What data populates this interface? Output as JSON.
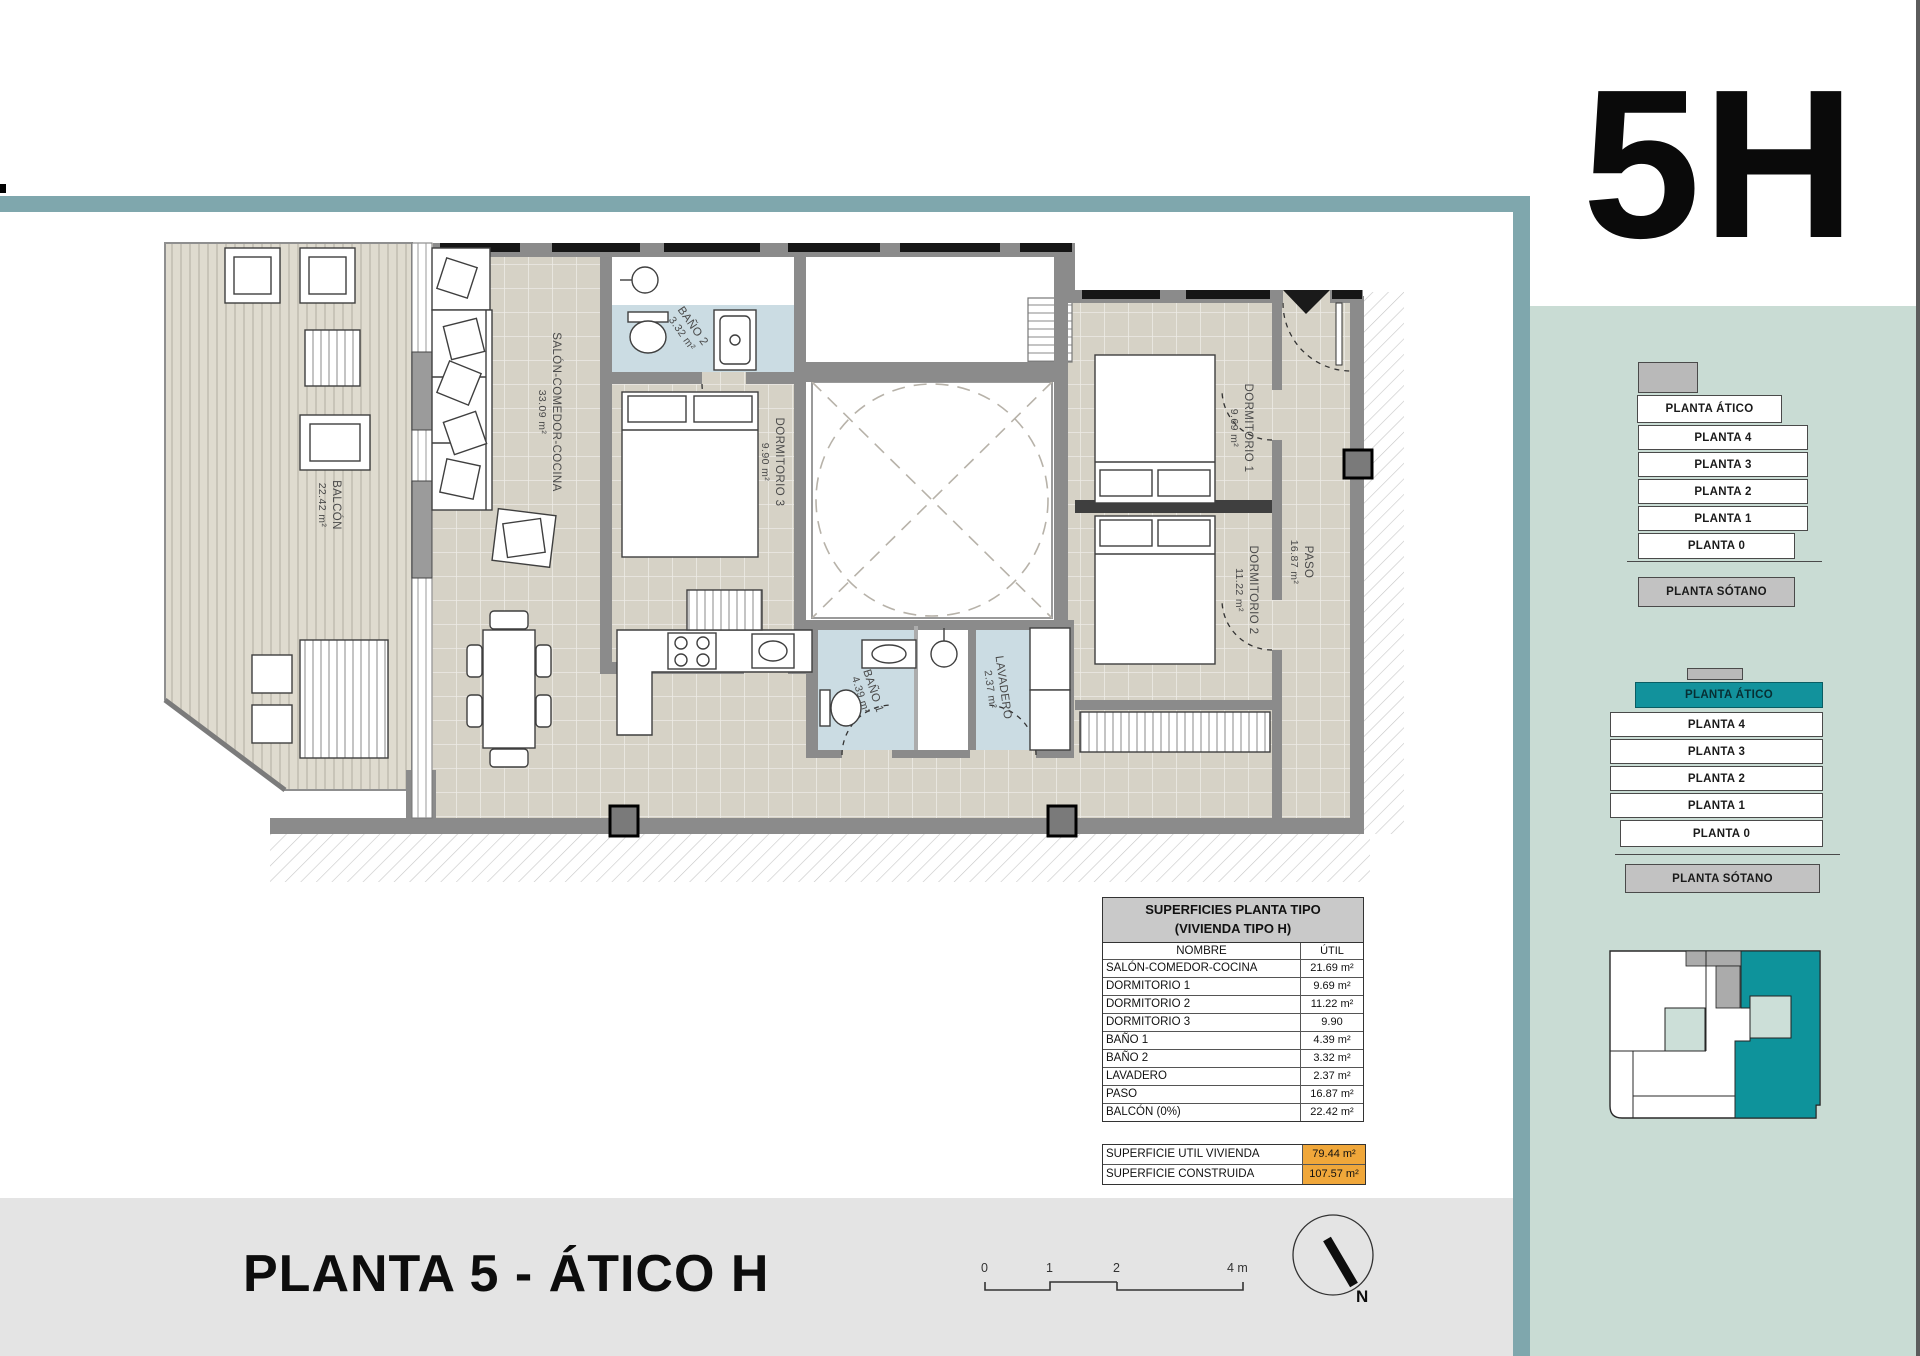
{
  "unit_code": "5H",
  "page_title": "PLANTA 5 - ÁTICO H",
  "colors": {
    "accent_teal": "#12929C",
    "band_teal": "#7FA7AD",
    "sidebar_bg": "#C9DCD4",
    "highlight_orange": "#F0A73A"
  },
  "plan": {
    "rooms": [
      {
        "name": "BALCÓN",
        "area": "22.42 m²"
      },
      {
        "name": "SALÓN-COMEDOR-COCINA",
        "area": "33.09 m²"
      },
      {
        "name": "BAÑO 2",
        "area": "3.32 m²"
      },
      {
        "name": "DORMITORIO 3",
        "area": "9.90 m²"
      },
      {
        "name": "DORMITORIO 1",
        "area": "9.69 m²"
      },
      {
        "name": "DORMITORIO 2",
        "area": "11.22 m²"
      },
      {
        "name": "PASO",
        "area": "16.87 m²"
      },
      {
        "name": "BAÑO 1",
        "area": "4.39 m²"
      },
      {
        "name": "LAVADERO",
        "area": "2.37 m²"
      }
    ],
    "compass_label": "N",
    "scale_labels": [
      "0",
      "1",
      "2",
      "4 m"
    ]
  },
  "area_table": {
    "title_line1": "SUPERFICIES PLANTA TIPO",
    "title_line2": "(VIVIENDA TIPO H)",
    "col_name": "NOMBRE",
    "col_util": "ÚTIL",
    "rows": [
      {
        "name": "SALÓN-COMEDOR-COCINA",
        "util": "21.69 m²"
      },
      {
        "name": "DORMITORIO 1",
        "util": "9.69 m²"
      },
      {
        "name": "DORMITORIO 2",
        "util": "11.22 m²"
      },
      {
        "name": "DORMITORIO 3",
        "util": "9.90"
      },
      {
        "name": "BAÑO 1",
        "util": "4.39 m²"
      },
      {
        "name": "BAÑO 2",
        "util": "3.32 m²"
      },
      {
        "name": "LAVADERO",
        "util": "2.37 m²"
      },
      {
        "name": "PASO",
        "util": "16.87 m²"
      },
      {
        "name": "BALCÓN (0%)",
        "util": "22.42 m²"
      }
    ],
    "totals": [
      {
        "name": "SUPERFICIE UTIL VIVIENDA",
        "value": "79.44 m²"
      },
      {
        "name": "SUPERFICIE CONSTRUIDA",
        "value": "107.57 m²"
      }
    ]
  },
  "selector_top": {
    "floors": [
      "PLANTA ÁTICO",
      "PLANTA 4",
      "PLANTA 3",
      "PLANTA 2",
      "PLANTA 1",
      "PLANTA 0",
      "PLANTA SÓTANO"
    ]
  },
  "selector_bottom": {
    "active": "PLANTA ÁTICO",
    "floors": [
      "PLANTA ÁTICO",
      "PLANTA 4",
      "PLANTA 3",
      "PLANTA 2",
      "PLANTA 1",
      "PLANTA 0",
      "PLANTA SÓTANO"
    ]
  }
}
